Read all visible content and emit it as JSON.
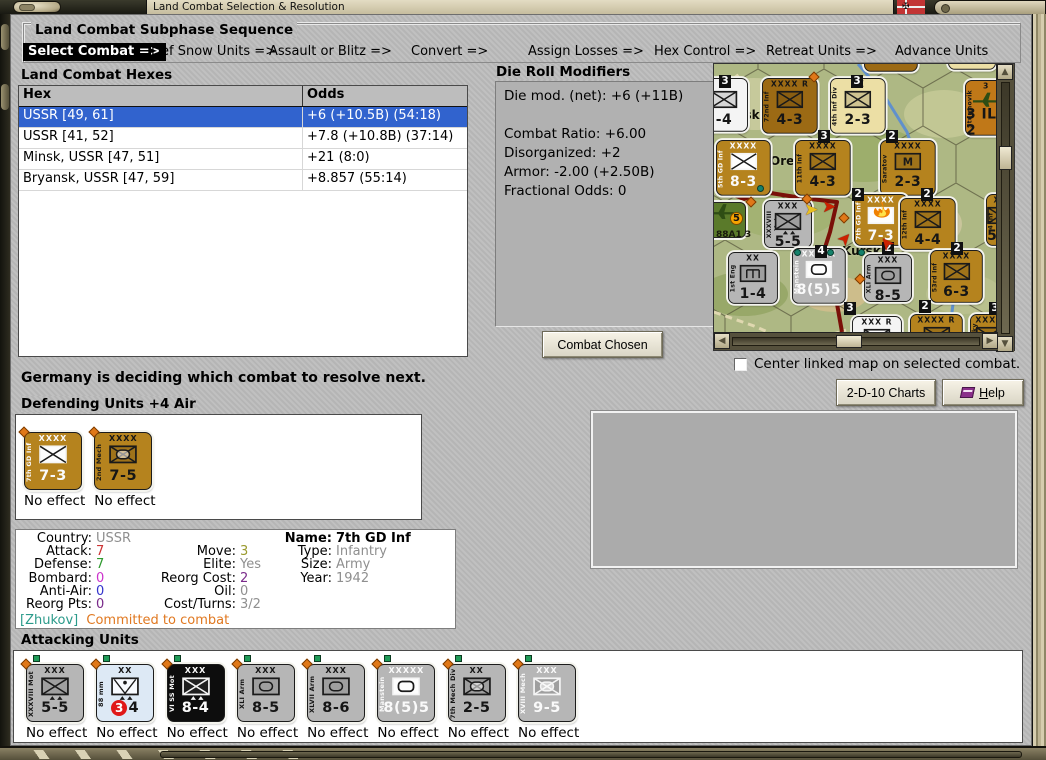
{
  "window": {
    "title": "Land Combat Selection & Resolution"
  },
  "subphase": {
    "title": "Land Combat Subphase Sequence",
    "steps": [
      {
        "label": "Select Combat =>",
        "active": true
      },
      {
        "label": "Def Snow Units =>",
        "active": false
      },
      {
        "label": "Assault or Blitz =>",
        "active": false
      },
      {
        "label": "Convert =>",
        "active": false
      },
      {
        "label": "Assign Losses =>",
        "active": false
      },
      {
        "label": "Hex Control =>",
        "active": false
      },
      {
        "label": "Retreat Units =>",
        "active": false
      },
      {
        "label": "Advance Units",
        "active": false
      }
    ]
  },
  "combat_hexes": {
    "title": "Land Combat Hexes",
    "columns": [
      "Hex",
      "Odds"
    ],
    "selection_color": "#3163ce",
    "rows": [
      {
        "hex": "USSR [49, 61]",
        "odds": "+6 (+10.5B) (54:18)",
        "selected": true
      },
      {
        "hex": "USSR [41, 52]",
        "odds": "+7.8 (+10.8B) (37:14)",
        "selected": false
      },
      {
        "hex": "Minsk, USSR [47, 51]",
        "odds": "+21 (8:0)",
        "selected": false
      },
      {
        "hex": "Bryansk, USSR [47, 59]",
        "odds": "+8.857 (55:14)",
        "selected": false
      }
    ]
  },
  "die_roll_modifiers": {
    "title": "Die Roll Modifiers",
    "lines": [
      "Die mod. (net): +6 (+11B)",
      "",
      "Combat Ratio: +6.00",
      "Disorganized: +2",
      "Armor: -2.00 (+2.50B)",
      "Fractional Odds: 0"
    ]
  },
  "buttons": {
    "combat_chosen": "Combat Chosen",
    "charts": "2-D-10 Charts",
    "help_u": "H",
    "help_rest": "elp"
  },
  "checkbox": {
    "label": "Center linked map on selected combat.",
    "checked": false
  },
  "status_text": "Germany is deciding which combat to resolve next.",
  "defending": {
    "title": "Defending Units +4 Air",
    "units": [
      {
        "name": "7th GD Inf",
        "size": "XXXX",
        "sym": "inf-white",
        "str": "7-3",
        "style": "brown",
        "light": true,
        "effect": "No effect"
      },
      {
        "name": "2nd Mech",
        "size": "XXXX",
        "sym": "mech",
        "str": "7-5",
        "style": "brown",
        "light": false,
        "effect": "No effect"
      }
    ]
  },
  "attacking": {
    "title": "Attacking Units",
    "units": [
      {
        "name": "XXXVIII Mot",
        "size": "XXX",
        "sym": "mot",
        "str": "5-5",
        "style": "gray",
        "light": false,
        "effect": "No effect"
      },
      {
        "name": "88 mm",
        "size": "XX",
        "sym": "aa",
        "str": "3-4",
        "badge": "3",
        "badge_rest": "4",
        "style": "lightblue",
        "light": false,
        "effect": "No effect"
      },
      {
        "name": "VI SS Mot",
        "size": "XXX",
        "sym": "mot",
        "str": "8-4",
        "style": "black",
        "light": true,
        "effect": "No effect"
      },
      {
        "name": "XLI Arm",
        "size": "XXX",
        "sym": "armor",
        "str": "8-5",
        "style": "gray",
        "light": false,
        "effect": "No effect"
      },
      {
        "name": "XLVII Arm",
        "size": "XXX",
        "sym": "armor",
        "str": "8-6",
        "style": "gray",
        "light": false,
        "effect": "No effect"
      },
      {
        "name": "Manstein",
        "size": "XXXXX",
        "sym": "hq",
        "str": "8(5)5",
        "style": "gray",
        "light": true,
        "effect": "No effect"
      },
      {
        "name": "7th Mech Div",
        "size": "XX",
        "sym": "mech",
        "str": "2-5",
        "style": "gray",
        "light": false,
        "effect": "No effect"
      },
      {
        "name": "XVIII Mech",
        "size": "XXX",
        "sym": "mech",
        "str": "9-5",
        "style": "gray",
        "light": true,
        "effect": "No effect"
      }
    ]
  },
  "unit_info": {
    "rows": [
      {
        "c1l": "Country:",
        "c1v": "USSR",
        "c1c": "#8f8f8f",
        "c2l": "",
        "c2v": "",
        "c2c": "#000",
        "c3l": "Name:",
        "c3v": "7th GD Inf",
        "c3c": "#000",
        "bold3": true
      },
      {
        "c1l": "Attack:",
        "c1v": "7",
        "c1c": "#cc3333",
        "c2l": "Move:",
        "c2v": "3",
        "c2c": "#9a9a2e",
        "c3l": "Type:",
        "c3v": "Infantry",
        "c3c": "#8f8f8f",
        "bold3": false
      },
      {
        "c1l": "Defense:",
        "c1v": "7",
        "c1c": "#2e9a2e",
        "c2l": "Elite:",
        "c2v": "Yes",
        "c2c": "#8f8f8f",
        "c3l": "Size:",
        "c3v": "Army",
        "c3c": "#8f8f8f",
        "bold3": false
      },
      {
        "c1l": "Bombard:",
        "c1v": "0",
        "c1c": "#cc33cc",
        "c2l": "Reorg Cost:",
        "c2v": "2",
        "c2c": "#7a2a8a",
        "c3l": "Year:",
        "c3v": "1942",
        "c3c": "#8f8f8f",
        "bold3": false
      },
      {
        "c1l": "Anti-Air:",
        "c1v": "0",
        "c1c": "#3333cc",
        "c2l": "Oil:",
        "c2v": "0",
        "c2c": "#8f8f8f",
        "c3l": "",
        "c3v": "",
        "c3c": "#000",
        "bold3": false
      },
      {
        "c1l": "Reorg Pts:",
        "c1v": "0",
        "c1c": "#7a2a8a",
        "c2l": "Cost/Turns:",
        "c2v": "3/2",
        "c2c": "#8f8f8f",
        "c3l": "",
        "c3v": "",
        "c3c": "#000",
        "bold3": false
      }
    ],
    "commander": "[Zhukov]",
    "commander_color": "#2a9a8a",
    "commander_status": "Committed to combat",
    "status_color": "#e07820"
  },
  "map": {
    "scroll": {
      "v": 0.28,
      "h": 0.47
    },
    "cities": [
      {
        "x": 22,
        "y": 44,
        "t": "nsk"
      },
      {
        "x": 56,
        "y": 90,
        "t": "Orel"
      },
      {
        "x": 128,
        "y": 180,
        "t": "Kursk"
      }
    ],
    "hex_numbers": [
      {
        "x": 5,
        "y": 11,
        "n": "3"
      },
      {
        "x": 137,
        "y": 11,
        "n": "3"
      },
      {
        "x": 104,
        "y": 66,
        "n": "3"
      },
      {
        "x": 172,
        "y": 66,
        "n": "2"
      },
      {
        "x": 138,
        "y": 124,
        "n": "2"
      },
      {
        "x": 207,
        "y": 124,
        "n": "2"
      },
      {
        "x": 101,
        "y": 181,
        "n": "4"
      },
      {
        "x": 168,
        "y": 178,
        "n": "2"
      },
      {
        "x": 237,
        "y": 178,
        "n": "2"
      },
      {
        "x": 130,
        "y": 238,
        "n": "3"
      },
      {
        "x": 205,
        "y": 236,
        "n": "2"
      },
      {
        "x": 275,
        "y": 238,
        "n": "3"
      }
    ],
    "front_line": [
      [
        0,
        123
      ],
      [
        30,
        135
      ],
      [
        50,
        128
      ],
      [
        88,
        134
      ],
      [
        123,
        138
      ],
      [
        116,
        168
      ],
      [
        108,
        193
      ],
      [
        120,
        223
      ],
      [
        128,
        268
      ]
    ],
    "river": [
      [
        144,
        0
      ],
      [
        168,
        28
      ],
      [
        193,
        68
      ],
      [
        205,
        103
      ],
      [
        213,
        138
      ],
      [
        233,
        173
      ],
      [
        243,
        208
      ],
      [
        238,
        248
      ],
      [
        246,
        268
      ]
    ],
    "roads": [
      [
        [
          0,
          248
        ],
        [
          40,
          262
        ],
        [
          84,
          281
        ]
      ],
      [
        [
          84,
          281
        ],
        [
          132,
          266
        ]
      ],
      [
        [
          0,
          30
        ],
        [
          28,
          8
        ]
      ]
    ],
    "green_dots": [
      [
        80,
        185
      ],
      [
        113,
        185
      ],
      [
        144,
        185
      ],
      [
        43,
        121
      ]
    ],
    "orange_diamonds": [
      [
        33,
        134
      ],
      [
        89,
        131
      ],
      [
        126,
        150
      ],
      [
        142,
        211
      ],
      [
        96,
        9
      ]
    ],
    "arrows": [
      {
        "x": 108,
        "y": 136,
        "r": 0,
        "c": "#cc2200"
      },
      {
        "x": 124,
        "y": 168,
        "r": -48,
        "c": "#cc2200"
      },
      {
        "x": 166,
        "y": 172,
        "r": -130,
        "c": "#cc2200"
      },
      {
        "x": 90,
        "y": 139,
        "r": 0,
        "c": "#e8c020"
      }
    ],
    "counters": [
      {
        "x": -14,
        "y": 14,
        "w": 50,
        "h": 56,
        "style": "white",
        "size": "",
        "sym": "inf",
        "str": "-4",
        "name": "",
        "light": false
      },
      {
        "x": 48,
        "y": 14,
        "w": 58,
        "h": 58,
        "style": "brown-dark",
        "size": "XXXX R",
        "sym": "inf",
        "str": "4-3",
        "name": "72nd Inf",
        "light": false
      },
      {
        "x": 116,
        "y": 14,
        "w": 58,
        "h": 58,
        "style": "cream",
        "size": "XX",
        "sym": "inf",
        "str": "2-3",
        "name": "4th Inf Div",
        "light": false
      },
      {
        "x": 251,
        "y": 16,
        "w": 44,
        "h": 58,
        "style": "orange",
        "size": "3",
        "sym": "air",
        "str": "3 IL-2",
        "name": "Sturmovik",
        "light": false
      },
      {
        "x": 2,
        "y": 76,
        "w": 57,
        "h": 58,
        "style": "brown",
        "size": "XXXX",
        "sym": "inf-white",
        "str": "8-3",
        "name": "5th GD Inf",
        "light": true
      },
      {
        "x": 81,
        "y": 76,
        "w": 58,
        "h": 58,
        "style": "brown",
        "size": "XXXX",
        "sym": "inf",
        "str": "4-3",
        "name": "11th Inf",
        "light": false
      },
      {
        "x": 166,
        "y": 76,
        "w": 58,
        "h": 58,
        "style": "brown",
        "size": "XXXX",
        "sym": "m",
        "str": "2-3",
        "name": "Saratov",
        "light": false
      },
      {
        "x": 50,
        "y": 136,
        "w": 50,
        "h": 50,
        "style": "gray",
        "size": "XXX",
        "sym": "mot",
        "str": "5-5",
        "name": "XXXVIII Mot",
        "light": false
      },
      {
        "x": 140,
        "y": 130,
        "w": 56,
        "h": 54,
        "style": "brown",
        "size": "XXXX",
        "sym": "fire",
        "str": "7-3",
        "name": "7th GD Inf",
        "light": true,
        "burning": true
      },
      {
        "x": 186,
        "y": 134,
        "w": 58,
        "h": 54,
        "style": "brown",
        "size": "XXXX",
        "sym": "inf",
        "str": "4-4",
        "name": "12th Inf",
        "light": false
      },
      {
        "x": 272,
        "y": 130,
        "w": 30,
        "h": 54,
        "style": "brown",
        "size": "XX",
        "sym": "inf",
        "str": "5-3",
        "name": "4 Inf",
        "light": false
      },
      {
        "x": 14,
        "y": 188,
        "w": 52,
        "h": 54,
        "style": "gray",
        "size": "XX",
        "sym": "eng",
        "str": "1-4",
        "name": "1st Eng",
        "light": false
      },
      {
        "x": 78,
        "y": 184,
        "w": 56,
        "h": 58,
        "style": "gray",
        "size": "XXXXX",
        "sym": "hq",
        "str": "8(5)5",
        "name": "Manstein",
        "light": true
      },
      {
        "x": 150,
        "y": 190,
        "w": 50,
        "h": 50,
        "style": "gray",
        "size": "XXX",
        "sym": "armor",
        "str": "8-5",
        "name": "XLI Arm",
        "light": false
      },
      {
        "x": 216,
        "y": 186,
        "w": 55,
        "h": 55,
        "style": "brown",
        "size": "XXXX",
        "sym": "inf",
        "str": "6-3",
        "name": "53rd Inf",
        "light": false
      },
      {
        "x": 138,
        "y": 252,
        "w": 52,
        "h": 40,
        "style": "white",
        "size": "XXX R",
        "sym": "inf-white",
        "str": "",
        "name": "",
        "light": false
      },
      {
        "x": 196,
        "y": 250,
        "w": 55,
        "h": 40,
        "style": "brown",
        "size": "XXXX R",
        "sym": "inf",
        "str": "",
        "name": "",
        "light": false
      },
      {
        "x": 256,
        "y": 250,
        "w": 40,
        "h": 40,
        "style": "brown",
        "size": "XXXX",
        "sym": "inf",
        "str": "",
        "name": "Lucky",
        "light": false
      },
      {
        "x": 150,
        "y": -46,
        "w": 56,
        "h": 56,
        "style": "brown-dark",
        "size": "",
        "sym": "inf",
        "str": "",
        "name": "",
        "light": false
      },
      {
        "x": 234,
        "y": -48,
        "w": 50,
        "h": 56,
        "style": "cream",
        "size": "",
        "sym": "inf",
        "str": "",
        "name": "",
        "light": false
      }
    ],
    "decor": {
      "air_base": {
        "x": -8,
        "y": 138
      },
      "air_badge": "5",
      "air_label": "88A1 3"
    }
  }
}
